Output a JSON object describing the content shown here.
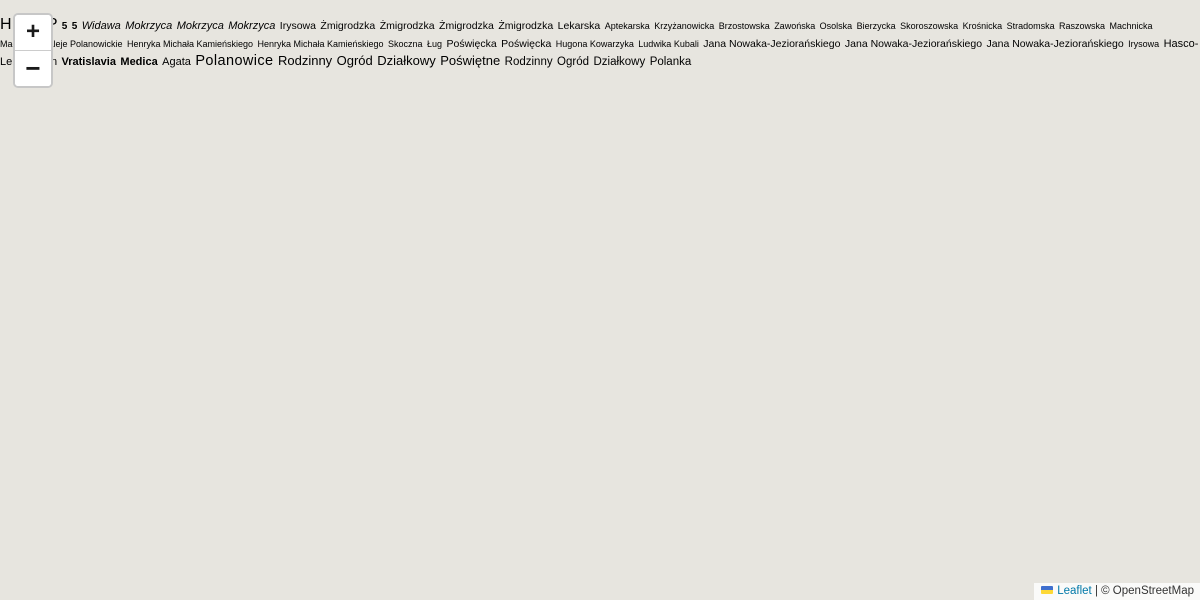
{
  "ui": {
    "zoom_in_label": "+",
    "zoom_out_label": "−",
    "attribution": {
      "leaflet": "Leaflet",
      "divider": "|",
      "copyright": "© OpenStreetMap"
    }
  },
  "colors": {
    "overlay_fill": "rgba(227,84,84,0.33)",
    "overlay_stroke": "#7c2f4c",
    "primary_road": "#fbd6a0",
    "water": "#aad0e2",
    "leaflet_link": "#0078A8"
  },
  "map": {
    "place": {
      "polanowice": "Polanowice"
    },
    "streams": {
      "widawa": "Widawa",
      "mokrzyca_left": "Mokrzyca",
      "mokrzyca_top": "Mokrzyca",
      "mokrzyca_right": "Mokrzyca"
    },
    "streets": {
      "irysowa_left": "Irysowa",
      "zmigrodzka_1": "Żmigrodzka",
      "zmigrodzka_2": "Żmigrodzka",
      "zmigrodzka_3": "Żmigrodzka",
      "zmigrodzka_4": "Żmigrodzka",
      "lekarska": "Lekarska",
      "aptekarska": "Aptekarska",
      "krzyzanowicka": "Krzyżanowicka",
      "brzostowska": "Brzostowska",
      "zawonska": "Zawońska",
      "osolska": "Osolska",
      "bierzycka": "Bierzycka",
      "skoroszowska": "Skoroszowska",
      "krosnicka": "Krośnicka",
      "stradomska": "Stradomska",
      "raszowska": "Raszowska",
      "machnicka_1": "Machnicka",
      "machnicka_2": "Machnicka",
      "aleje_polanowickie": "Aleje Polanowickie",
      "kamienskiego_1": "Henryka Michała Kamieńskiego",
      "kamienskiego_2": "Henryka Michała Kamieńskiego",
      "skoczna": "Skoczna",
      "lug": "Ług",
      "poswiecka_1": "Poświęcka",
      "poswiecka_2": "Poświęcka",
      "hugona_kowarzyka": "Hugona Kowarzyka",
      "ludwika_kubali": "Ludwika Kubali",
      "jezioranskiego_clipped": "Jana Nowaka-Jeziorańskiego",
      "jezioranskiego_1": "Jana Nowaka-Jeziorańskiego",
      "jezioranskiego_2": "Jana Nowaka-Jeziorańskiego",
      "irysowa_2": "Irysowa"
    },
    "pois": {
      "hasco_1": "Hasco-",
      "hasco_2": "Lek",
      "haston": "Haston",
      "vratislavia_1": "Vratislavia",
      "vratislavia_2": "Medica",
      "agata": "Agata"
    },
    "areas": {
      "poswietne": {
        "line1": "Rodzinny",
        "line2": "Ogród",
        "line3": "Działkowy",
        "line4": "Poświętne"
      },
      "polanka": {
        "line1": "Rodzinny",
        "line2": "Ogród",
        "line3": "Działkowy",
        "line4": "Polanka"
      }
    },
    "road_refs": {
      "ref_top": "5",
      "ref_bottom": "5"
    },
    "icons": {
      "helipad_glyph": "H",
      "parking_glyph": "P"
    }
  }
}
